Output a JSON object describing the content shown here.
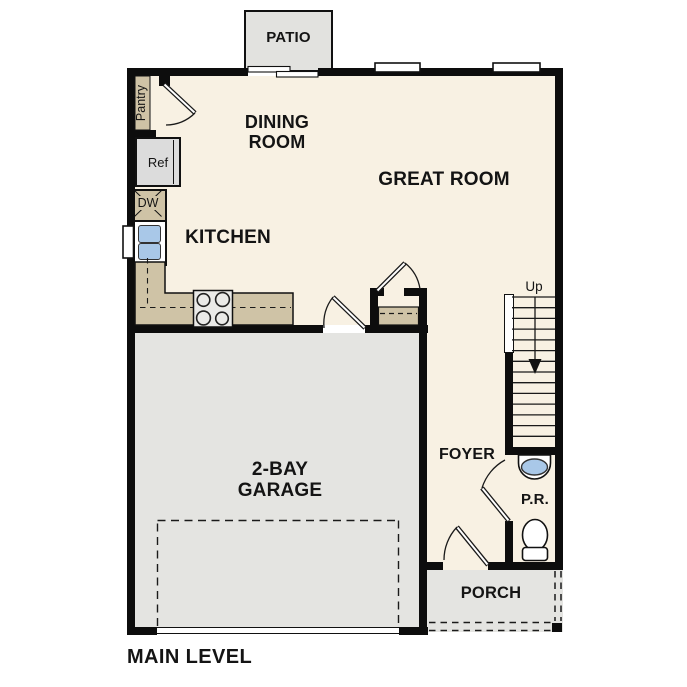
{
  "title": "MAIN LEVEL",
  "rooms": {
    "patio": "PATIO",
    "dining_room": "DINING ROOM",
    "great_room": "GREAT ROOM",
    "kitchen": "KITCHEN",
    "garage": "2-BAY GARAGE",
    "foyer": "FOYER",
    "powder_room": "P.R.",
    "porch": "PORCH"
  },
  "fixtures": {
    "pantry": "Pantry",
    "refrigerator": "Ref",
    "dishwasher": "DW",
    "stair_direction": "Up"
  },
  "colors": {
    "page_bg": "#ffffff",
    "floor_cream": "#f8f1e3",
    "counter_tan": "#cfc3a6",
    "concrete_gray": "#e4e4e1",
    "patio_gray": "#e2e2df",
    "appliance_gray": "#dcdcdc",
    "stove_gray": "#eaeae8",
    "sink_blue": "#a9c8e8",
    "wall_black": "#0d0d0d"
  }
}
